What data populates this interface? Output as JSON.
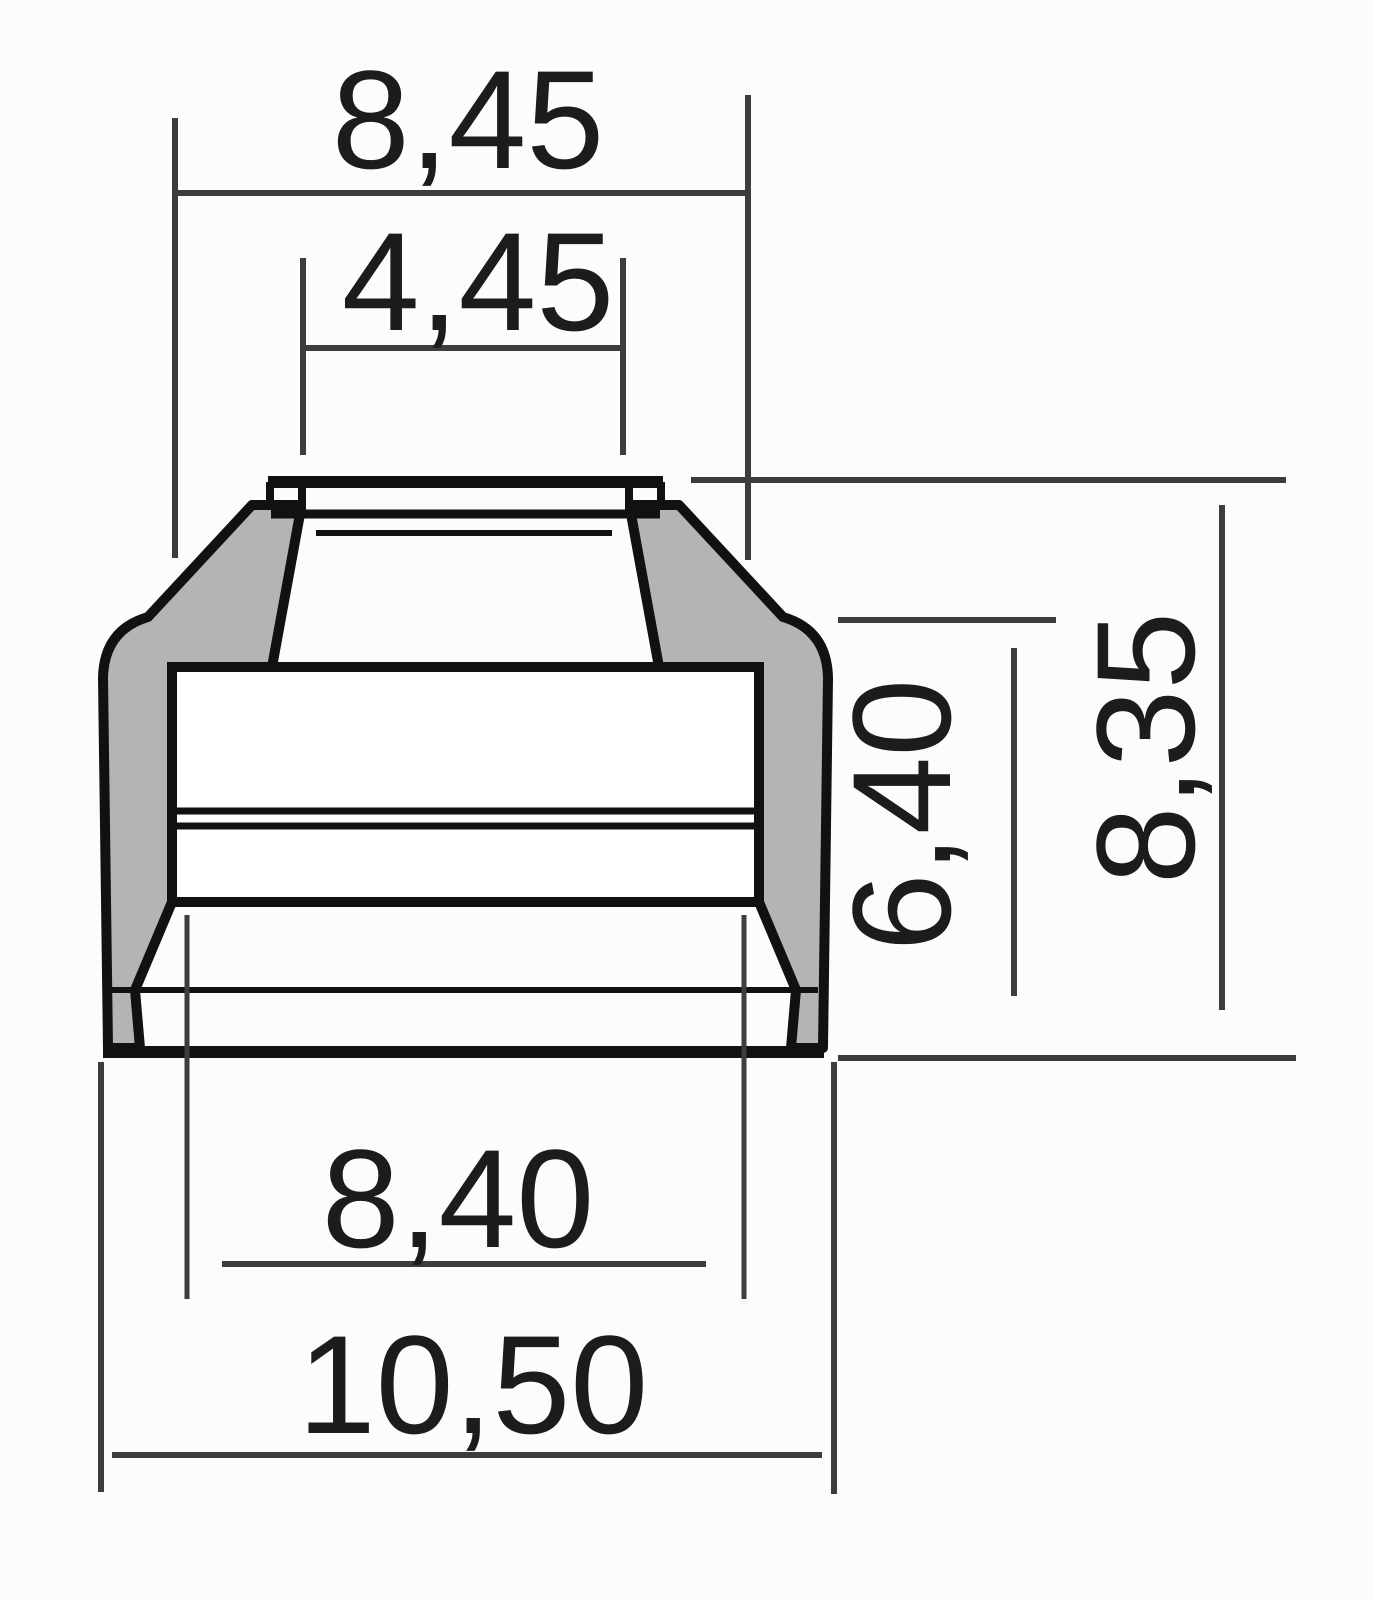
{
  "drawing": {
    "colors": {
      "background": "#fcfcfc",
      "body_fill": "#b4b4b4",
      "outline": "#111111",
      "dimension_line": "#3d3d3d",
      "text": "#1c1c1c"
    },
    "dimensions": {
      "outer_top_width": "8,45",
      "inner_top_width": "4,45",
      "shoulder_height": "6,40",
      "total_height": "8,35",
      "inner_bottom_width": "8,40",
      "outer_bottom_width": "10,50"
    }
  }
}
